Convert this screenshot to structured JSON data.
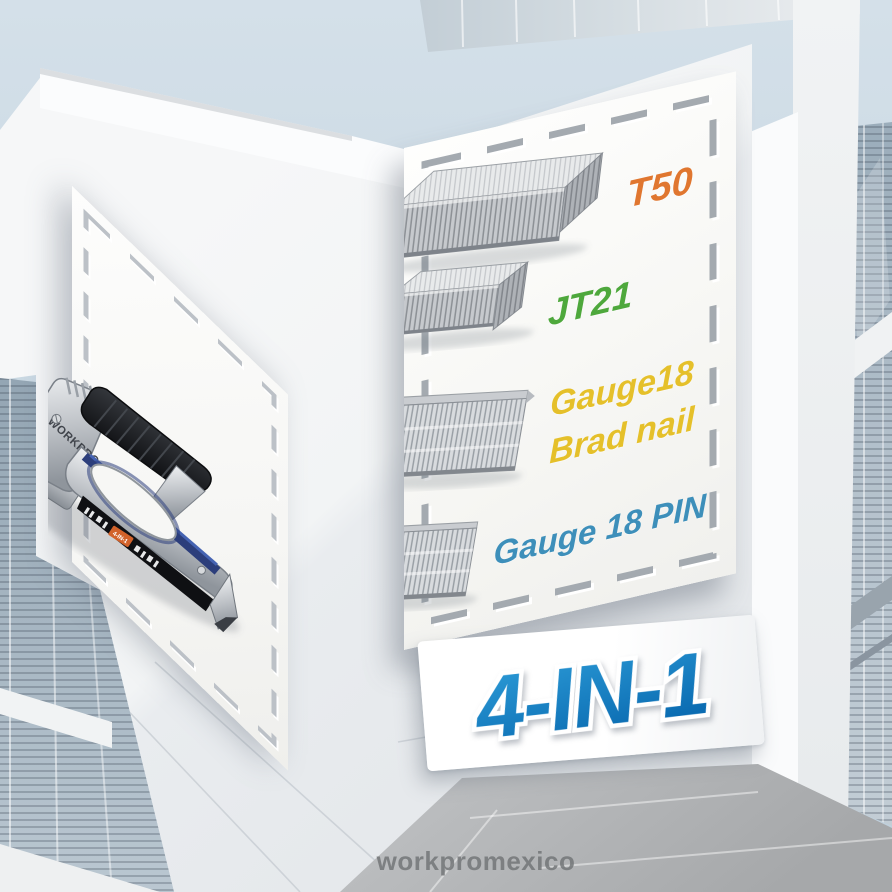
{
  "watermark": {
    "text": "workpromexico"
  },
  "banner": {
    "text": "4-IN-1",
    "color": "#1180c6"
  },
  "gun_panel": {
    "brand": "WORKPRO",
    "badge": "4-IN-1",
    "accent_color": "#2c3e7b",
    "badge_color": "#d2622a"
  },
  "staples_panel": {
    "items": [
      {
        "label": "T50",
        "color": "#e0762f"
      },
      {
        "label": "JT21",
        "color": "#4ea83c"
      },
      {
        "lines": [
          "Gauge18",
          "Brad nail"
        ],
        "color": "#e5c02a"
      },
      {
        "label": "Gauge 18 PIN",
        "color": "#3d8fba"
      }
    ]
  }
}
